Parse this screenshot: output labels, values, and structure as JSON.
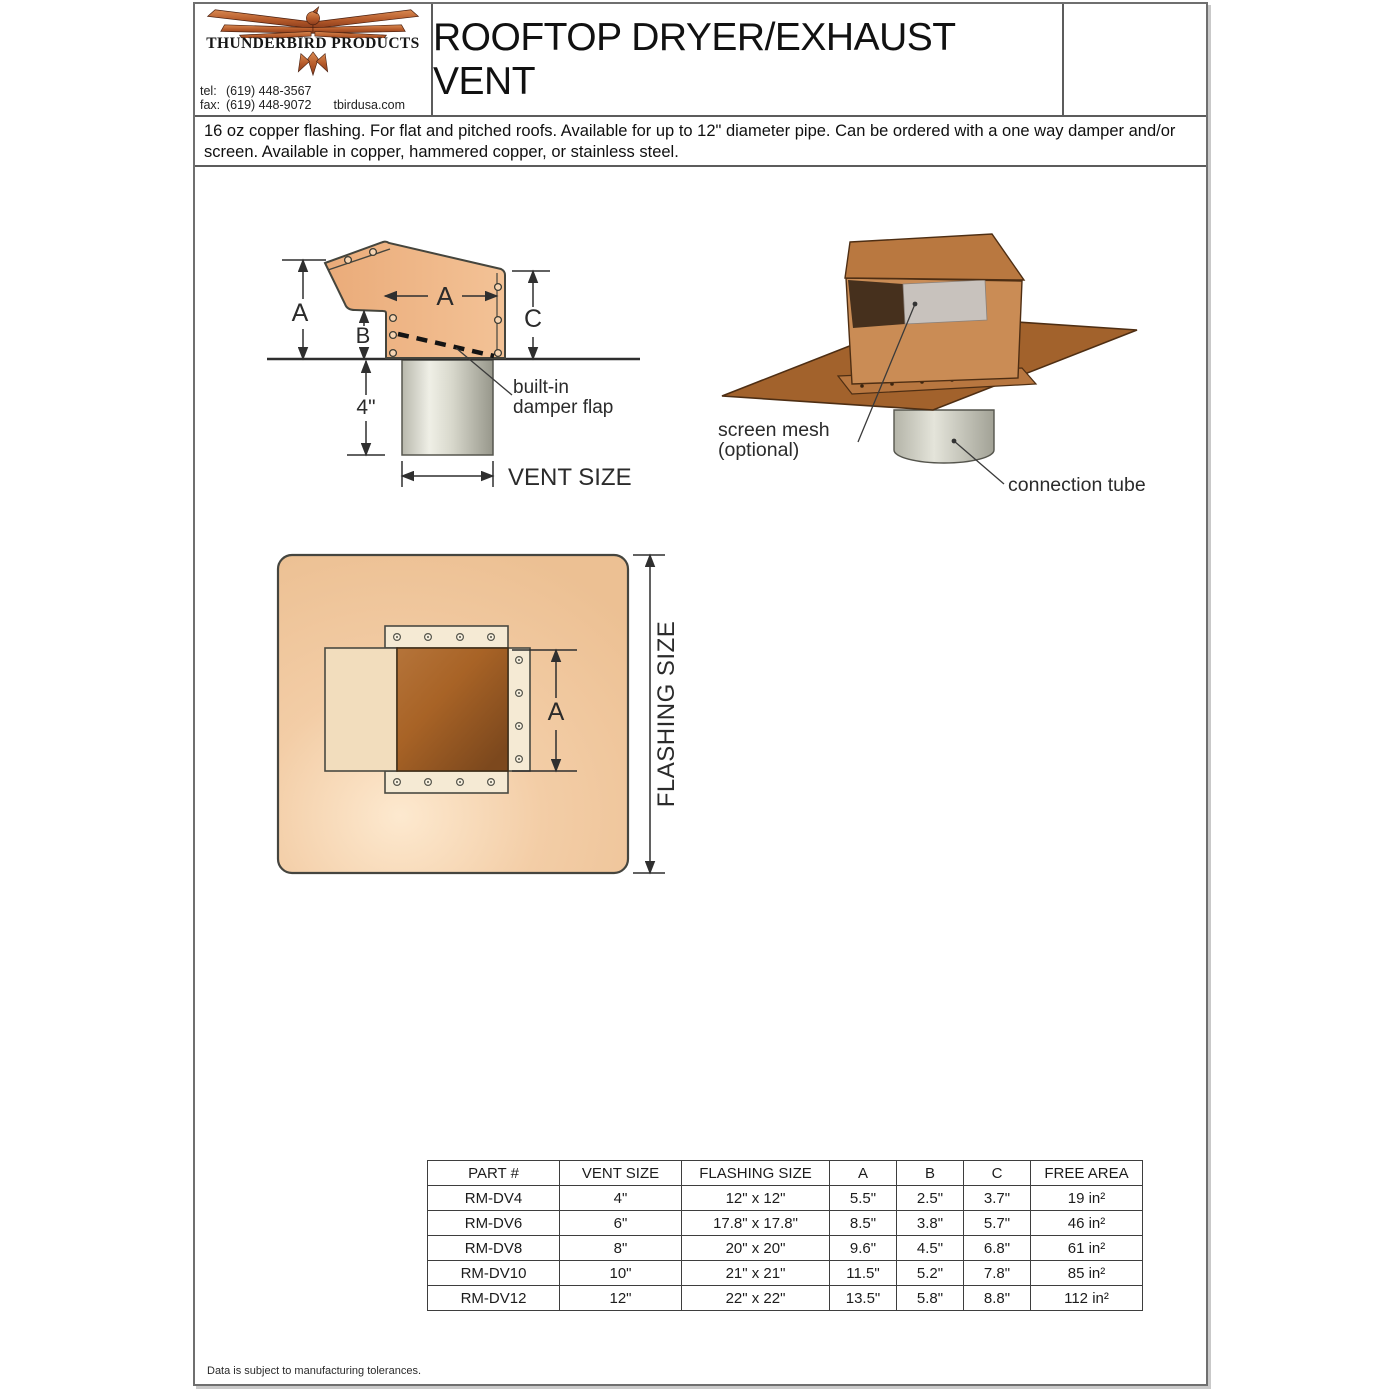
{
  "header": {
    "company": "THUNDERBIRD PRODUCTS",
    "contact": {
      "tel_label": "tel:",
      "tel": "(619) 448-3567",
      "fax_label": "fax:",
      "fax": "(619) 448-9072",
      "website": "tbirdusa.com"
    },
    "title": "ROOFTOP DRYER/EXHAUST VENT"
  },
  "description": "16 oz copper flashing. For flat and pitched roofs. Available for up to 12\" diameter pipe. Can be ordered with a one way damper and/or screen. Available in copper, hammered copper, or stainless steel.",
  "diagrams": {
    "side_view": {
      "dim_a_left": "A",
      "dim_a_width": "A",
      "dim_b": "B",
      "dim_c": "C",
      "dim_tube_length": "4\"",
      "vent_size_label": "VENT SIZE",
      "damper_line1": "built-in",
      "damper_line2": "damper flap"
    },
    "iso_view": {
      "screen_line1": "screen mesh",
      "screen_line2": "(optional)",
      "connection_tube_label": "connection tube"
    },
    "top_view": {
      "dim_a": "A",
      "flashing_size_label": "FLASHING SIZE"
    }
  },
  "table": {
    "headers": [
      "PART #",
      "VENT SIZE",
      "FLASHING SIZE",
      "A",
      "B",
      "C",
      "FREE AREA"
    ],
    "rows": [
      [
        "RM-DV4",
        "4\"",
        "12\" x 12\"",
        "5.5\"",
        "2.5\"",
        "3.7\"",
        "19 in²"
      ],
      [
        "RM-DV6",
        "6\"",
        "17.8\" x 17.8\"",
        "8.5\"",
        "3.8\"",
        "5.7\"",
        "46 in²"
      ],
      [
        "RM-DV8",
        "8\"",
        "20\" x 20\"",
        "9.6\"",
        "4.5\"",
        "6.8\"",
        "61 in²"
      ],
      [
        "RM-DV10",
        "10\"",
        "21\" x 21\"",
        "11.5\"",
        "5.2\"",
        "7.8\"",
        "85 in²"
      ],
      [
        "RM-DV12",
        "12\"",
        "22\" x 22\"",
        "13.5\"",
        "5.8\"",
        "8.8\"",
        "112 in²"
      ]
    ]
  },
  "footer": "Data is subject to manufacturing tolerances.",
  "colors": {
    "copper_light": "#edb283",
    "copper_mid": "#c9854f",
    "copper_dark": "#a2622c",
    "flashing_peach": "#f3cda6",
    "screen_gray": "#c8c2bd",
    "tube_gray": "#c9c9c0",
    "line_dark": "#3a3a3a"
  }
}
